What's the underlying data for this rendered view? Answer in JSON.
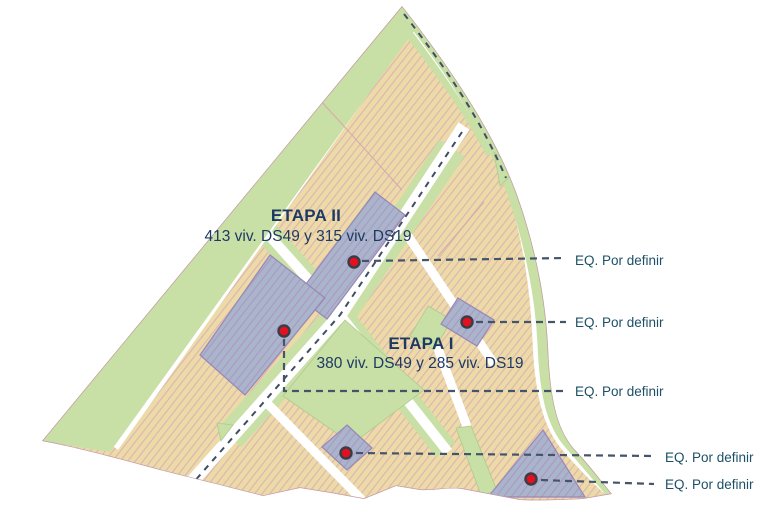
{
  "map": {
    "stages": [
      {
        "id": "etapa-2",
        "title": "ETAPA II",
        "detail": "413 viv. DS49 y 315 viv. DS19"
      },
      {
        "id": "etapa-1",
        "title": "ETAPA I",
        "detail": "380 viv. DS49 y 285 viv. DS19"
      }
    ],
    "equipment_points": [
      {
        "label": "EQ. Por definir",
        "dot_x": 354,
        "dot_y": 262
      },
      {
        "label": "EQ. Por definir",
        "dot_x": 467,
        "dot_y": 322
      },
      {
        "label": "EQ. Por definir",
        "dot_x": 284,
        "dot_y": 331
      },
      {
        "label": "EQ. Por definir",
        "dot_x": 346,
        "dot_y": 453
      },
      {
        "label": "EQ. Por definir",
        "dot_x": 531,
        "dot_y": 479
      }
    ],
    "colors": {
      "parcel_tan": "#ECDAA7",
      "parcel_tan_hatch": "#DEB2B4",
      "parcel_blue": "#A8B5CB",
      "parcel_blue_hatch": "#AE96C3",
      "green_area": "#C8DFA6",
      "road": "#FFFFFF",
      "boundary": "#C49BA6",
      "marker_red": "#E3101F",
      "marker_ring": "#3C3C46",
      "leader_line": "#44546A",
      "title_navy": "#1E3A63",
      "eq_label_teal": "#1D5066"
    }
  }
}
